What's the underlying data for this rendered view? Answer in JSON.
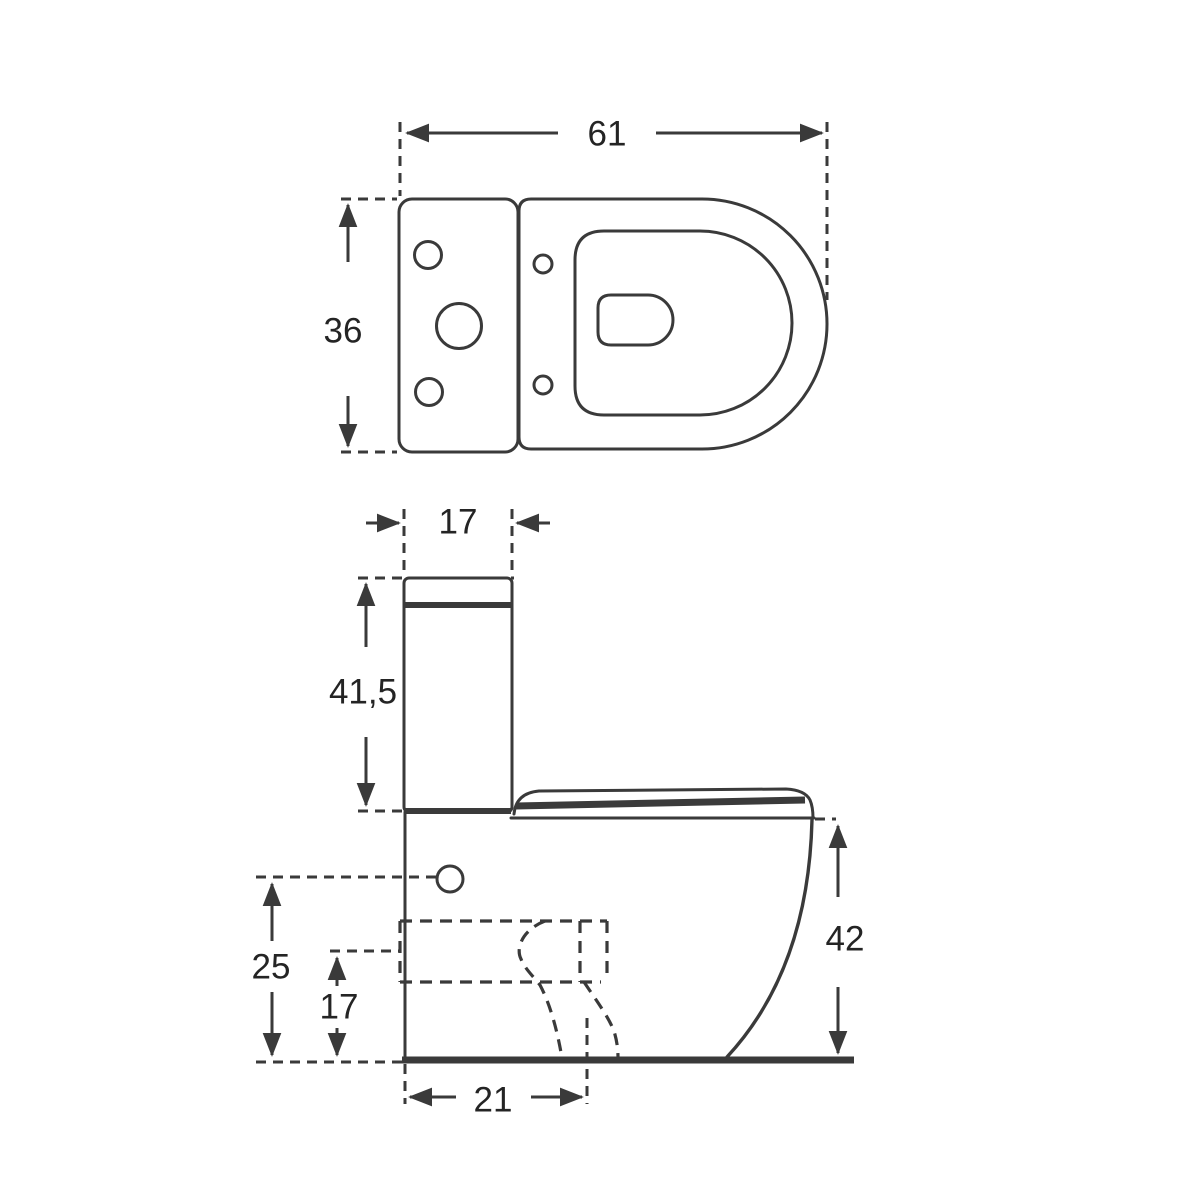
{
  "page": {
    "background_color": "#ffffff",
    "line_color": "#3a3a3a",
    "text_color": "#242424",
    "description": "Technical dimension drawing of a close-coupled toilet: top view and side view"
  },
  "top_view": {
    "overall_width": "61",
    "overall_depth": "36"
  },
  "side_view": {
    "cistern_depth": "17",
    "cistern_height": "41,5",
    "rim_height": "42",
    "flush_inlet_height": "25",
    "outlet_height": "17",
    "outlet_setout": "21"
  }
}
